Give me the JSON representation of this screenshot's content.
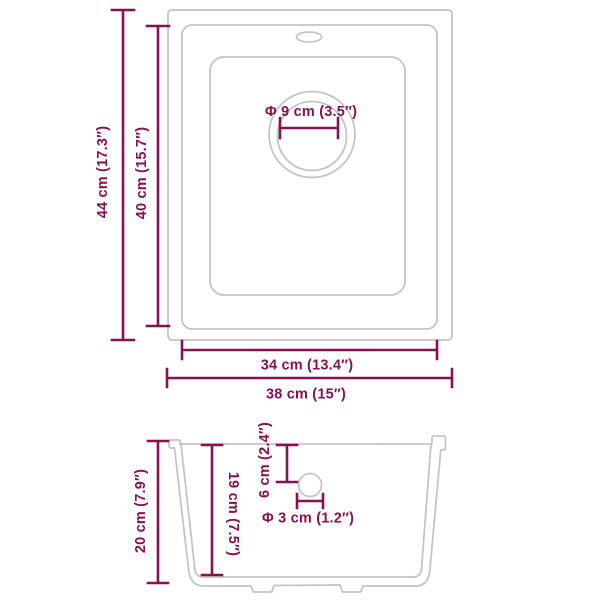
{
  "colors": {
    "accent": "#871152",
    "outline": "#C4C4C4"
  },
  "top_view": {
    "outer_height_label": "44 cm (17.3″)",
    "inner_height_label": "40 cm (15.7″)",
    "drain_diameter_label": "Φ 9 cm (3.5″)",
    "inner_width_label": "34 cm (13.4″)",
    "outer_width_label": "38 cm (15″)"
  },
  "side_view": {
    "height_label": "20 cm (7.9″)",
    "inner_depth_label": "19 cm (7.5″)",
    "drain_top_offset_label": "6 cm (2.4″)",
    "drain_hole_label": "Φ 3 cm (1.2″)"
  }
}
